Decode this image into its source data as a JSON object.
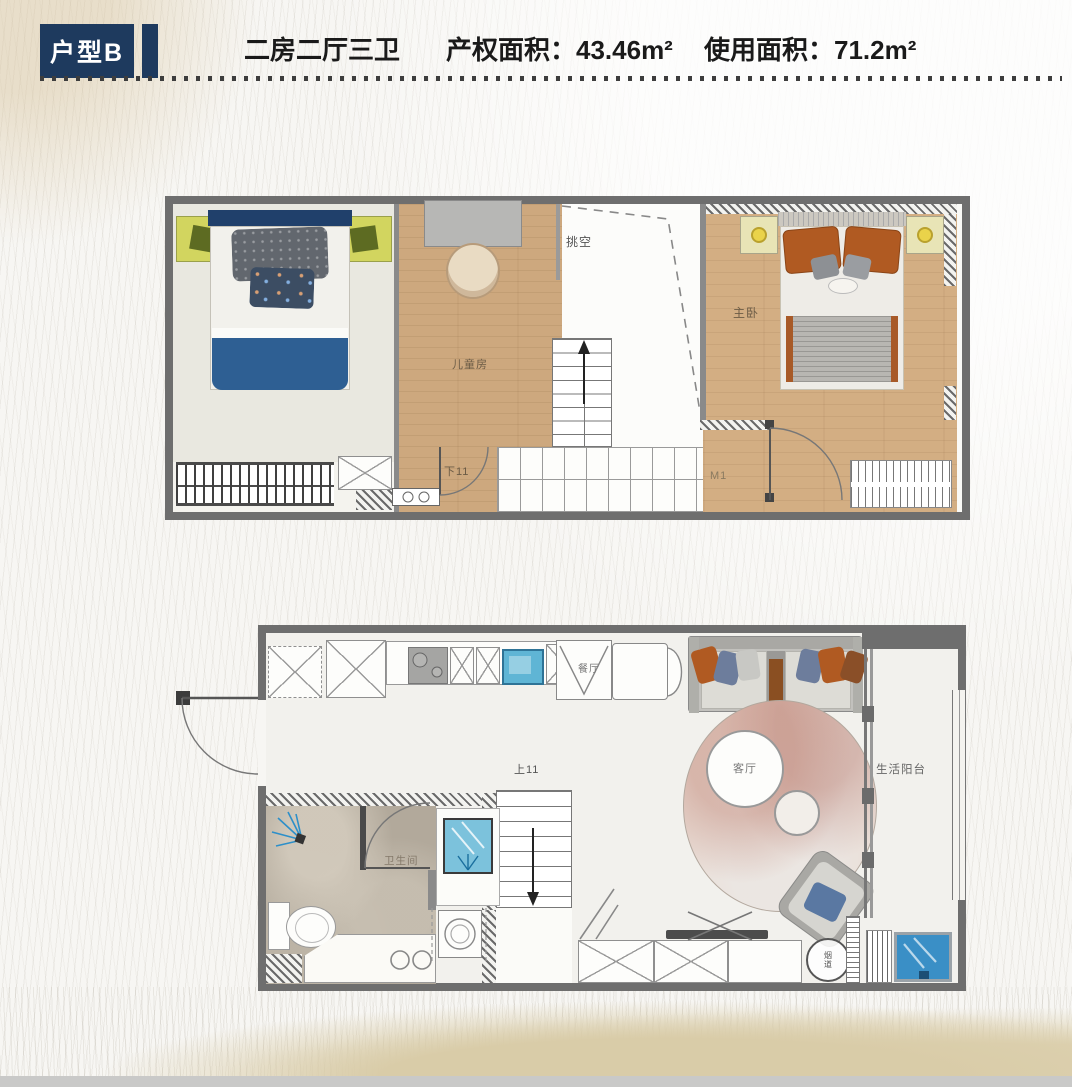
{
  "header": {
    "badge": "户型B",
    "layout": "二房二厅三卫",
    "property_area": "产权面积：43.46m²",
    "usable_area": "使用面积：71.2m²"
  },
  "upper_floor": {
    "kids_room": "儿童房",
    "void": "挑空",
    "master_bedroom": "主卧",
    "stairs_down": "下11",
    "door_code": "M1"
  },
  "lower_floor": {
    "dining": "餐厅",
    "living": "客厅",
    "balcony": "生活阳台",
    "bathroom": "卫生间",
    "stairs_up": "上11",
    "flue": "烟道"
  },
  "colors": {
    "navy": "#1e3a5e",
    "wall": "#6e6e6e",
    "wood": "#cda87e",
    "blanket_blue": "#2e5f93",
    "pillow_orange": "#b05a22",
    "nightstand_green": "#d2d55f",
    "lamp_yellow": "#ead34a",
    "sink_blue": "#5fb5d5",
    "basin_blue": "#3a8fc6"
  }
}
